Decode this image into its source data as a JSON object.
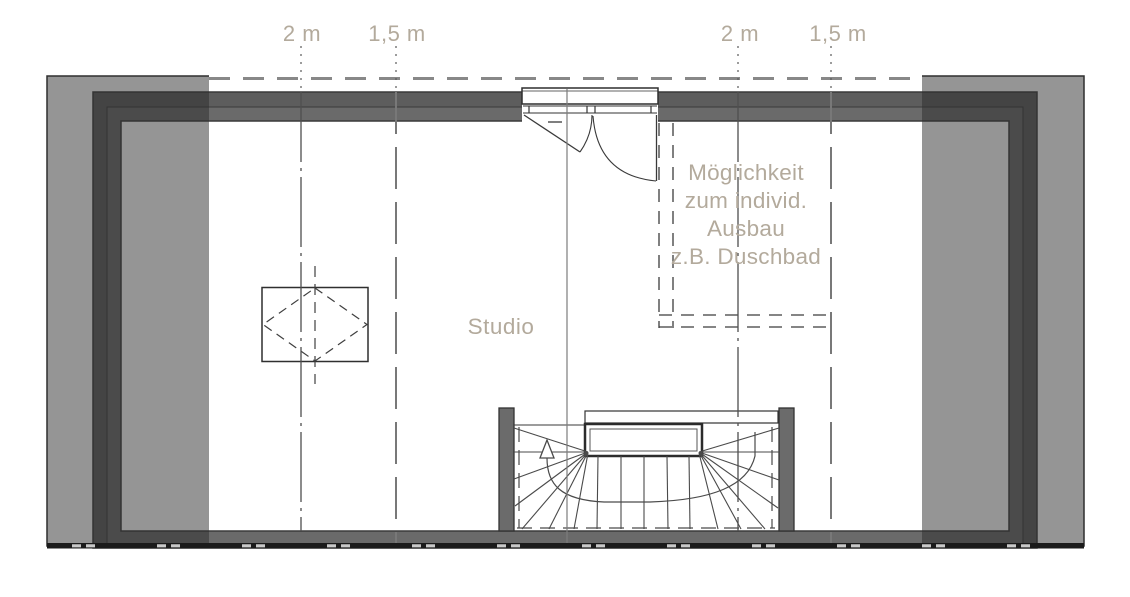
{
  "plan": {
    "room_label": "Studio",
    "annotation": {
      "lines": [
        "Möglichkeit",
        "zum individ.",
        "Ausbau",
        "z.B. Duschbad"
      ]
    },
    "dimensions": {
      "left_2m": "2 m",
      "left_1_5m": "1,5 m",
      "right_2m": "2 m",
      "right_1_5m": "1,5 m"
    },
    "colors": {
      "label_text": "#b3aa9c",
      "wall_dark": "#5d5d5d",
      "wall_mid": "#6a6a6a",
      "low_headroom_overlay": "rgba(44,44,44,0.5)",
      "linework": "#3a3a3a",
      "roof_edge_dash": "#888888",
      "section_cut": "#1b1b1b"
    }
  }
}
